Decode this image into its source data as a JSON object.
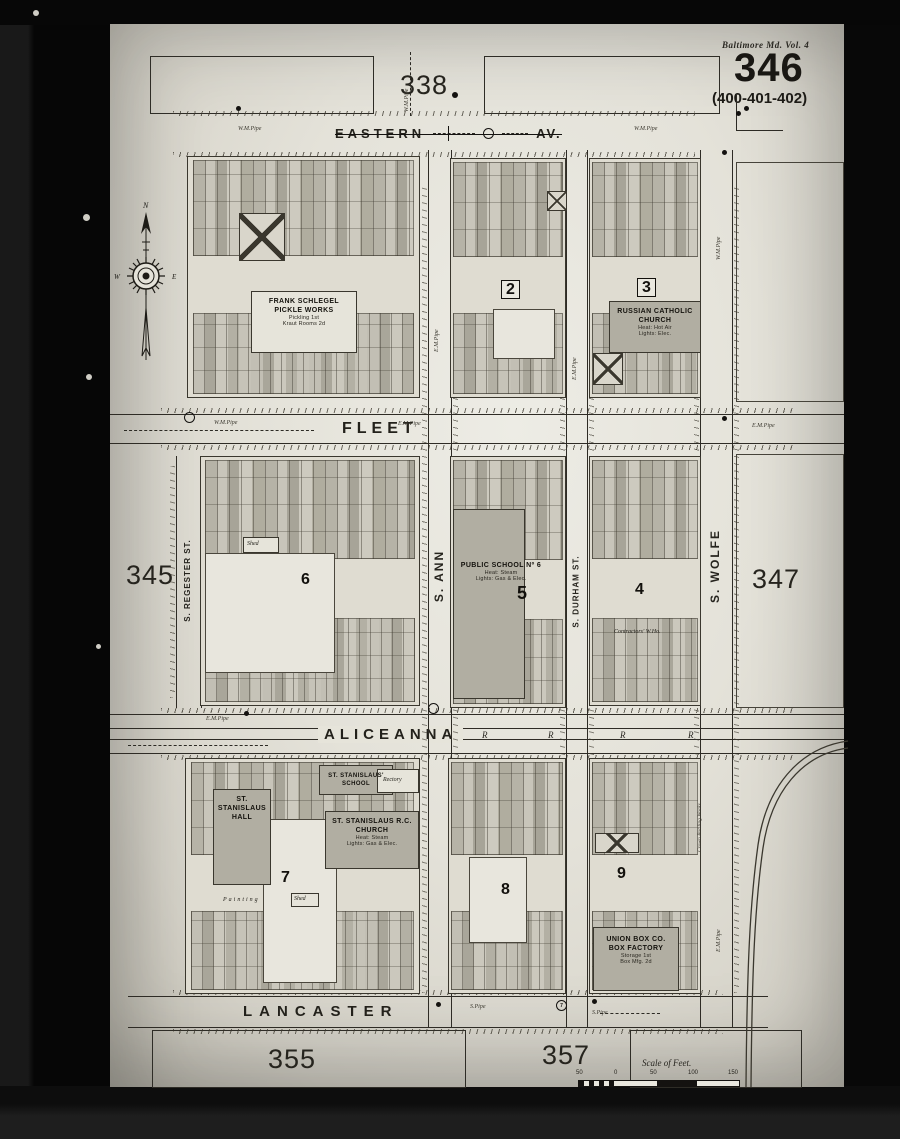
{
  "header": {
    "volume_label": "Baltimore Md. Vol. 4",
    "sheet_number": "346",
    "page_range": "(400-401-402)"
  },
  "adjacent_sheets": {
    "top": "338",
    "left": "345",
    "right": "347",
    "bottom_left": "355",
    "bottom_right": "357"
  },
  "streets": {
    "eastern": {
      "name": "EASTERN",
      "suffix": "AV."
    },
    "fleet": {
      "name": "FLEET"
    },
    "aliceanna": {
      "name": "ALICEANNA"
    },
    "lancaster": {
      "name": "LANCASTER"
    },
    "regester": {
      "name": "S. REGESTER ST."
    },
    "ann": {
      "name": "S. ANN"
    },
    "durham": {
      "name": "S. DURHAM ST."
    },
    "wolfe": {
      "name": "S. WOLFE"
    }
  },
  "railroad": {
    "letter": "R"
  },
  "compass": {
    "north": "N",
    "west": "W",
    "east": "E"
  },
  "blocks": {
    "b1": {
      "labels": {
        "l1": "Frank Schlegel",
        "l2": "Pickle Works",
        "s1": "Pickling 1st",
        "s2": "Kraut Rooms 2d"
      }
    },
    "b2": {
      "number": "2"
    },
    "b3": {
      "number": "3",
      "labels": {
        "l1": "Russian Catholic",
        "l2": "Church",
        "s1": "Heat: Hot Air",
        "s2": "Lights: Elec."
      }
    },
    "b6": {
      "number": "6",
      "labels": {
        "shed": "Shed"
      }
    },
    "b5": {
      "number": "5",
      "labels": {
        "l1": "Public School Nº 6",
        "s1": "Heat: Steam",
        "s2": "Lights: Gas & Elec."
      }
    },
    "b4": {
      "number": "4",
      "labels": {
        "l1": "Contractors' W.Ho."
      }
    },
    "b7": {
      "number": "7",
      "labels": {
        "hall1": "St. Stanislaus",
        "hall2": "Hall",
        "school": "St. Stanislaus' School",
        "rectory": "Rectory",
        "church1": "St. Stanislaus R.C.",
        "church2": "Church",
        "cs1": "Heat: Steam",
        "cs2": "Lights: Gas & Elec.",
        "painting": "Painting",
        "shed": "Shed"
      }
    },
    "b8": {
      "number": "8"
    },
    "b9": {
      "number": "9",
      "labels": {
        "l1": "Union Box Co.",
        "l2": "Box Factory",
        "s1": "Storage 1st",
        "s2": "Box Mfg. 2d"
      }
    }
  },
  "annotations": {
    "crown": "Crown Bottling Works",
    "pipe_wm": "W.M.Pipe",
    "pipe_em": "E.M.Pipe",
    "pipe_s": "S.Pipe",
    "marker7": "7"
  },
  "scale": {
    "title": "Scale of Feet.",
    "ticks": [
      "50",
      "0",
      "50",
      "100",
      "150"
    ]
  }
}
